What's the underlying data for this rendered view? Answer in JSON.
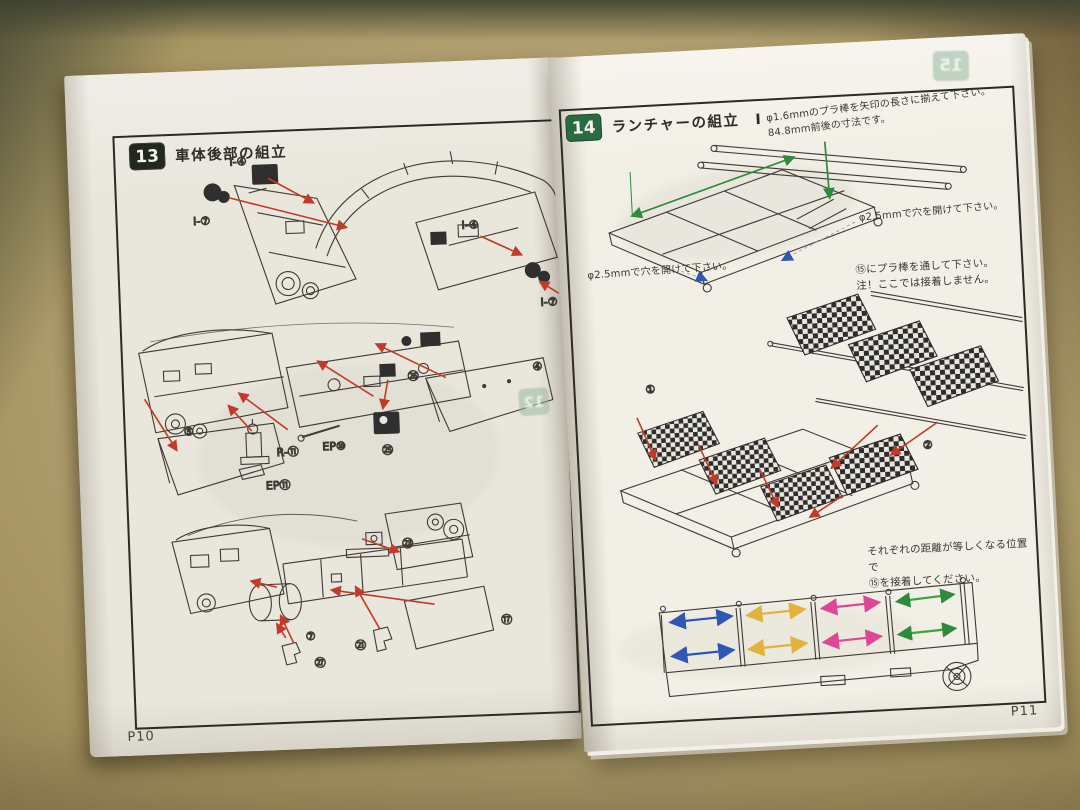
{
  "page": {
    "left": {
      "page_number": "P10",
      "step_number": "13",
      "step_title": "車体後部の組立",
      "bleed_badge": "12",
      "labels": {
        "i4_top": "I-④",
        "i7_left": "I-⑦",
        "i4_mid": "I-④",
        "i7_right": "I-⑦",
        "part26": "㉖",
        "part25": "㉕",
        "flap_right": "④",
        "flap_left": "⑤",
        "ep10": "EP⑩",
        "r11": "R-⑪",
        "ep11": "EP⑪",
        "part23": "㉓",
        "part21": "㉑",
        "part17": "⑰",
        "part7": "⑦",
        "part27": "㉗"
      }
    },
    "right": {
      "page_number": "P11",
      "step_number": "14",
      "step_title": "ランチャーの組立　Ⅰ",
      "bleed_badge": "15",
      "notes": {
        "rod_length_line1": "φ1.6mmのプラ棒を矢印の長さに揃えて下さい。",
        "rod_length_line2": "84.8mm前後の寸法です。",
        "drill_right": "φ2.5mmで穴を開けて下さい。",
        "drill_left": "φ2.5mmで穴を開けて下さい。",
        "pass_rod_line1": "⑮にプラ棒を通して下さい。",
        "pass_rod_line2": "注！ここでは接着しません。",
        "equal_line1": "それぞれの距離が等しくなる位置で",
        "equal_line2": "⑮を接着してください。"
      },
      "labels": {
        "part1": "①",
        "part2": "②"
      }
    }
  }
}
